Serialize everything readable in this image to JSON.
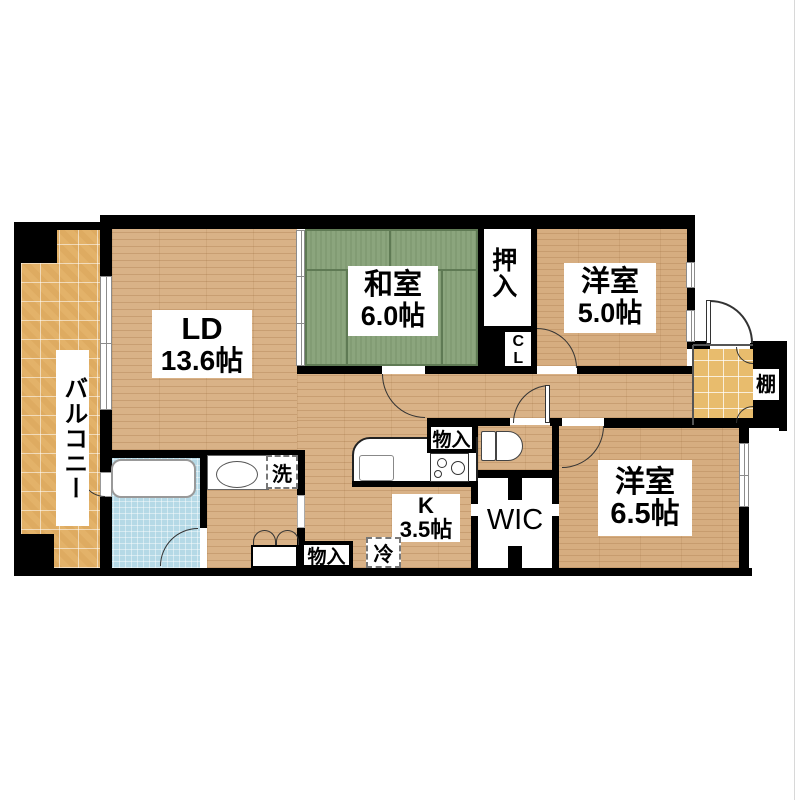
{
  "plan_title": "2LDK floor plan",
  "colors": {
    "wall": "#000000",
    "wood_floor": "#d9b287",
    "tatami": "#8ba57d",
    "balcony_tile": "#e3b269",
    "genkan_tile": "#e8bc6d",
    "bathroom": "#b5d9e6"
  },
  "rooms": {
    "balcony": {
      "label": "バルコニー"
    },
    "living_dining": {
      "label": "LD",
      "size": "13.6帖"
    },
    "japanese_room": {
      "label": "和室",
      "size": "6.0帖"
    },
    "oshiire": {
      "label": "押入"
    },
    "closet": {
      "label": "CL"
    },
    "western_room_5": {
      "label": "洋室",
      "size": "5.0帖"
    },
    "shelf": {
      "label": "棚"
    },
    "western_room_65": {
      "label": "洋室",
      "size": "6.5帖"
    },
    "wic": {
      "label": "WIC"
    },
    "kitchen": {
      "label": "K",
      "size": "3.5帖"
    },
    "storage_hall": {
      "label": "物入"
    },
    "storage_lower": {
      "label": "物入"
    },
    "washer_space": {
      "label": "洗"
    },
    "fridge_space": {
      "label": "冷"
    }
  }
}
